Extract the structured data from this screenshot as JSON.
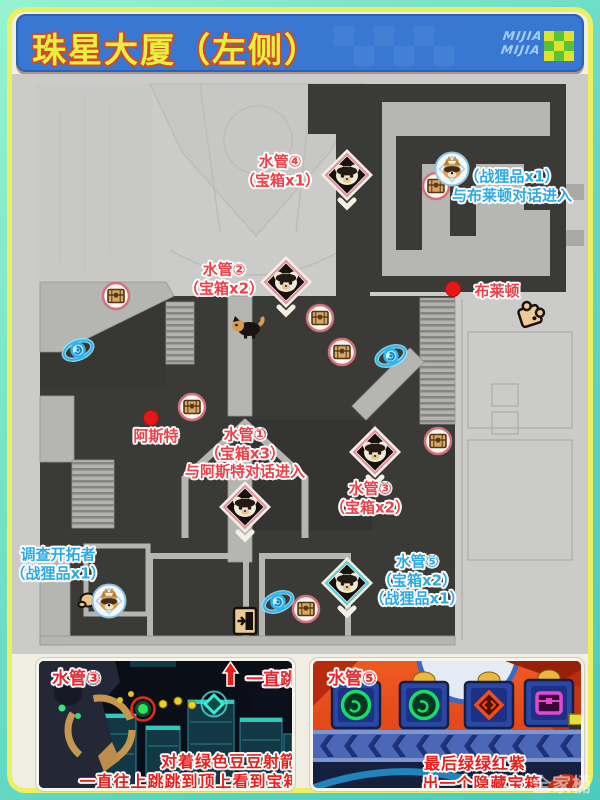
{
  "title": "珠星大厦（左侧）",
  "logo": {
    "line1": "MIJIA",
    "line2": "MIJIA"
  },
  "map": {
    "pipe4": {
      "l1": "水管④",
      "l2": "（宝箱x1）"
    },
    "loot_top": {
      "l1": "（战狸品x1）",
      "l2": "与布莱顿对话进入"
    },
    "pipe2": {
      "l1": "水管②",
      "l2": "（宝箱x2）"
    },
    "brayton": {
      "name": "布莱顿"
    },
    "aster": {
      "name": "阿斯特"
    },
    "pipe1": {
      "l1": "水管①",
      "l2": "（宝箱x3）",
      "l3": "与阿斯特对话进入"
    },
    "pipe3": {
      "l1": "水管③",
      "l2": "（宝箱x2）"
    },
    "pipe5": {
      "l1": "水管⑤",
      "l2": "（宝箱x2）",
      "l3": "（战狸品x1）"
    },
    "investigate": {
      "l1": "调查开拓者",
      "l2": "（战狸品x1）"
    }
  },
  "panel_left": {
    "title": "水管③",
    "jump": "一直跳",
    "cap1": "对着绿色豆豆射箭",
    "cap2": "一直往上跳跳到顶上看到宝箱"
  },
  "panel_right": {
    "title": "水管⑤",
    "cap1": "最后绿绿红紫",
    "cap2": "出一个隐藏宝箱"
  },
  "watermark": {
    "text": "全家桶"
  },
  "colors": {
    "banner_blue": "#3877d2",
    "title_yellow": "#e9ef3e",
    "label_red": "#ef3f48",
    "label_blue": "#2da9e4",
    "frame_teal": "#63d8c5",
    "frame_yellow": "#edf05e",
    "caption_red": "#e81f1c",
    "map_floor_dark": "#3a3a37",
    "map_bg": "#cbcbc9"
  }
}
